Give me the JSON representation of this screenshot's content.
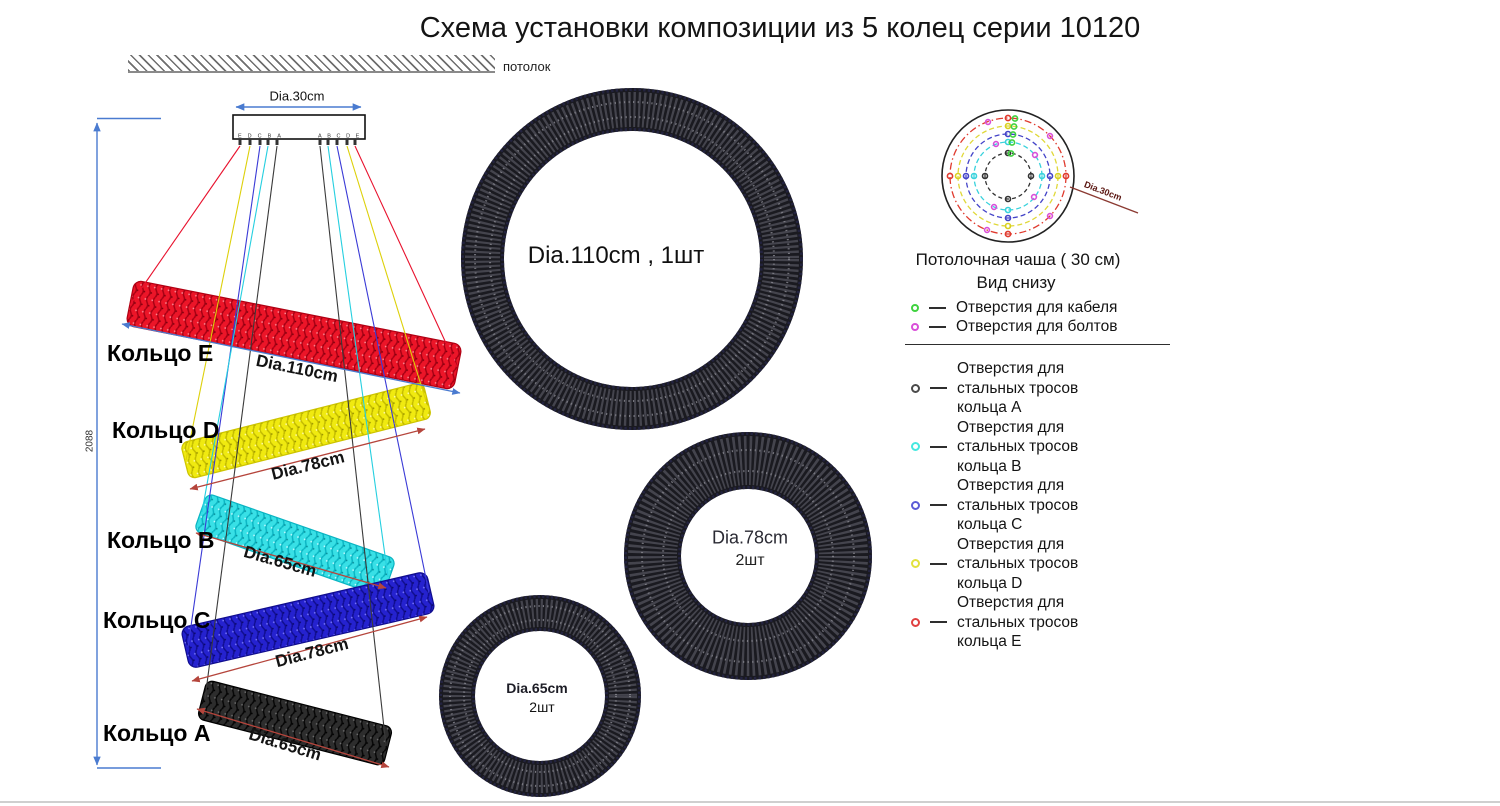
{
  "title": "Схема установки композиции из 5 колец серии 10120",
  "ceiling": {
    "label": "потолок"
  },
  "mount": {
    "diameter_label": "Dia.30cm",
    "height_label": "2088",
    "hook_labels_left": "EDCBA",
    "hook_labels_right": "ABCDE"
  },
  "side_rings": [
    {
      "name": "Кольцо E",
      "dim": "Dia.110cm",
      "color": "#ec1528"
    },
    {
      "name": "Кольцо D",
      "dim": "Dia.78cm",
      "color": "#f0ea10"
    },
    {
      "name": "Кольцо B",
      "dim": "Dia.65cm",
      "color": "#38e0e6"
    },
    {
      "name": "Кольцо C",
      "dim": "Dia.78cm",
      "color": "#2522cf"
    },
    {
      "name": "Кольцо A",
      "dim": "Dia.65cm",
      "color": "#262626"
    }
  ],
  "top_rings": [
    {
      "label": "Dia.110cm , 1шт"
    },
    {
      "label": "Dia.78cm",
      "qty": "2шт"
    },
    {
      "label": "Dia.65cm",
      "qty": "2шт"
    }
  ],
  "cup": {
    "dim_label": "Dia.30cm",
    "caption_line1": "Потолочная чаша ( 30 см)",
    "caption_line2": "Вид снизу"
  },
  "legend": {
    "top_items": [
      {
        "label": "Отверстия для кабеля",
        "color": "#3fd23f"
      },
      {
        "label": "Отверстия для болтов",
        "color": "#d94fd9"
      }
    ],
    "ring_items": [
      {
        "label": "Отверстия для\nстальных тросов\nкольца A",
        "color": "#4a4a4a"
      },
      {
        "label": "Отверстия для\nстальных тросов\nкольца B",
        "color": "#45e8e0"
      },
      {
        "label": "Отверстия для\nстальных тросов\nкольца C",
        "color": "#5b5bd6"
      },
      {
        "label": "Отверстия для\nстальных тросов\nкольца D",
        "color": "#e2e23e"
      },
      {
        "label": "Отверстия для\nстальных тросов\nкольца E",
        "color": "#e04040"
      }
    ]
  },
  "colors": {
    "dimension_blue": "#4a7bd0",
    "dimension_red": "#b5453c"
  }
}
